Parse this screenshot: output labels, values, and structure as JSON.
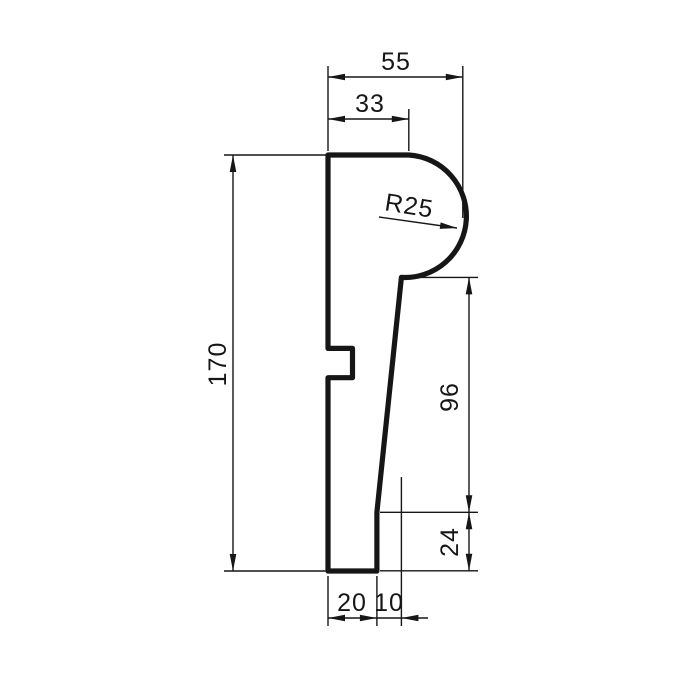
{
  "drawing": {
    "kind": "technical-profile-cross-section",
    "colors": {
      "line": "#161616",
      "background": "#ffffff"
    }
  },
  "dims": {
    "total_width": "55",
    "top_flat_width": "33",
    "radius": "R25",
    "total_height": "170",
    "front_upper_height": "96",
    "front_lower_height": "24",
    "bottom_width": "20",
    "bottom_offset": "10"
  }
}
